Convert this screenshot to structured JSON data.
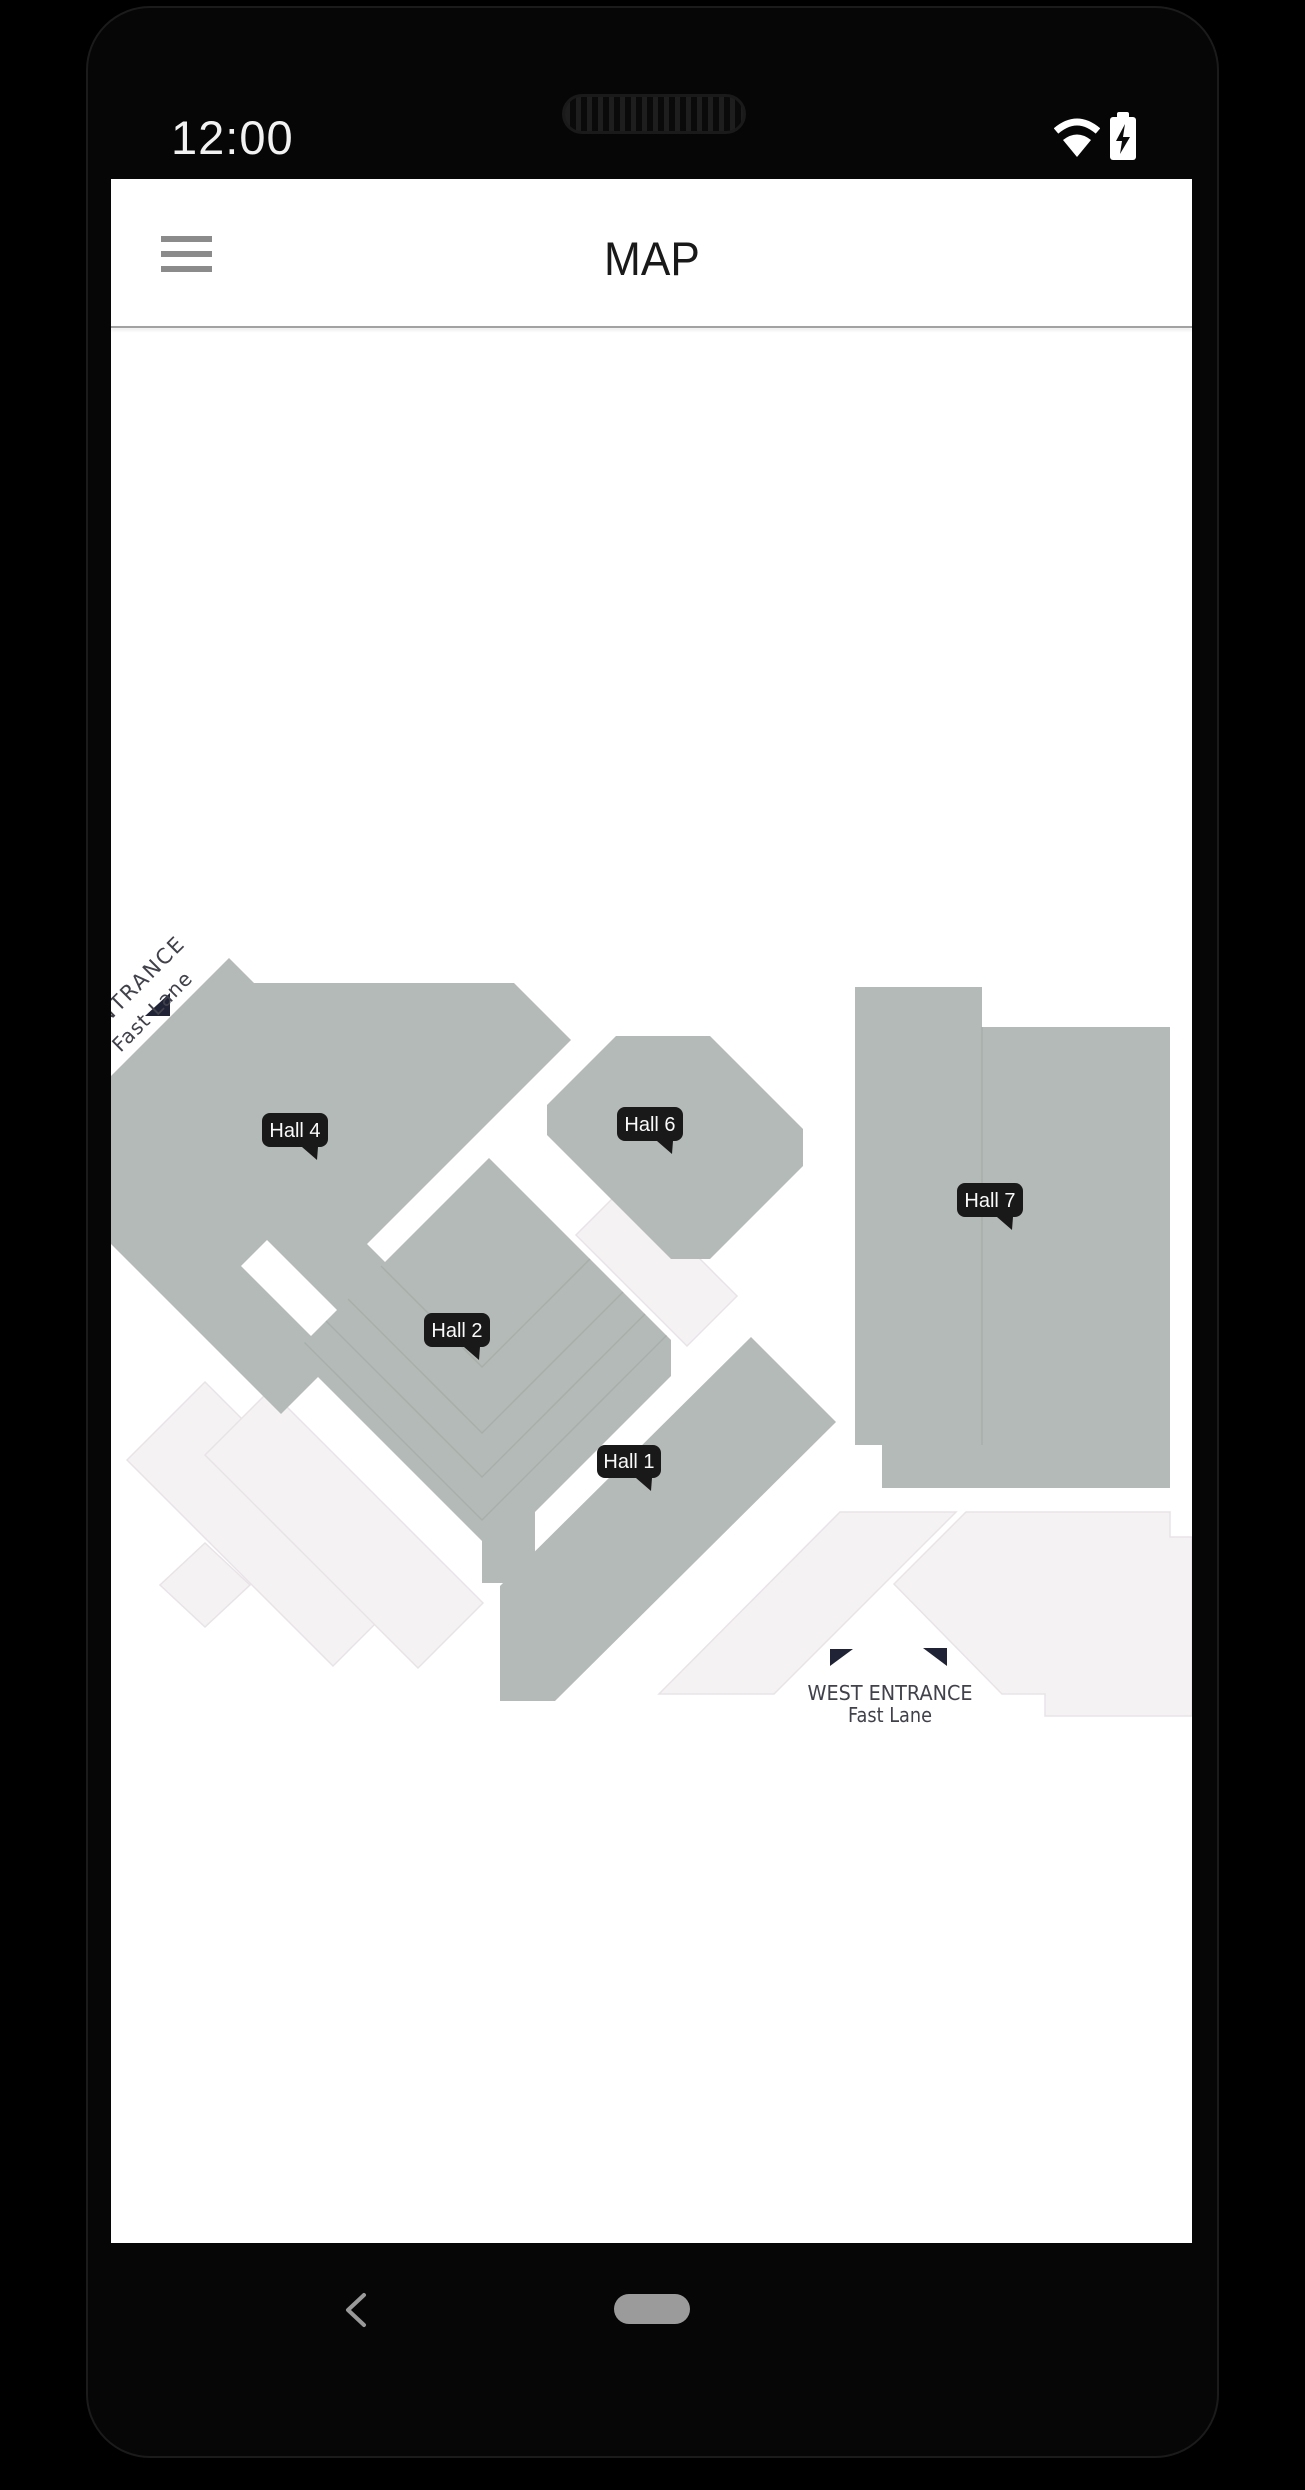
{
  "status_bar": {
    "time": "12:00",
    "wifi_icon": "wifi",
    "battery_icon": "battery-charging"
  },
  "app_bar": {
    "title": "MAP",
    "menu_icon": "hamburger-menu"
  },
  "map": {
    "halls": [
      {
        "id": "hall-4",
        "label": "Hall 4"
      },
      {
        "id": "hall-2",
        "label": "Hall 2"
      },
      {
        "id": "hall-6",
        "label": "Hall 6"
      },
      {
        "id": "hall-7",
        "label": "Hall 7"
      },
      {
        "id": "hall-1",
        "label": "Hall 1"
      }
    ],
    "west_entrance": {
      "line1": "WEST  ENTRANCE",
      "line2": "Fast Lane"
    },
    "side_entrance": {
      "line1": "ENTRANCE",
      "line2": "Fast Lane"
    },
    "colors": {
      "hall_fill": "#b4bab7",
      "hall_line": "#a8afab",
      "light_fill": "#f5f2f4",
      "light_line": "#e8e3e7",
      "badge_bg": "#191919",
      "badge_text": "#fafafa",
      "entrance_text": "#41414b",
      "arrow_color": "#1f2335"
    }
  },
  "nav_bar": {
    "back_icon": "back-chevron",
    "home_icon": "home-indicator"
  }
}
